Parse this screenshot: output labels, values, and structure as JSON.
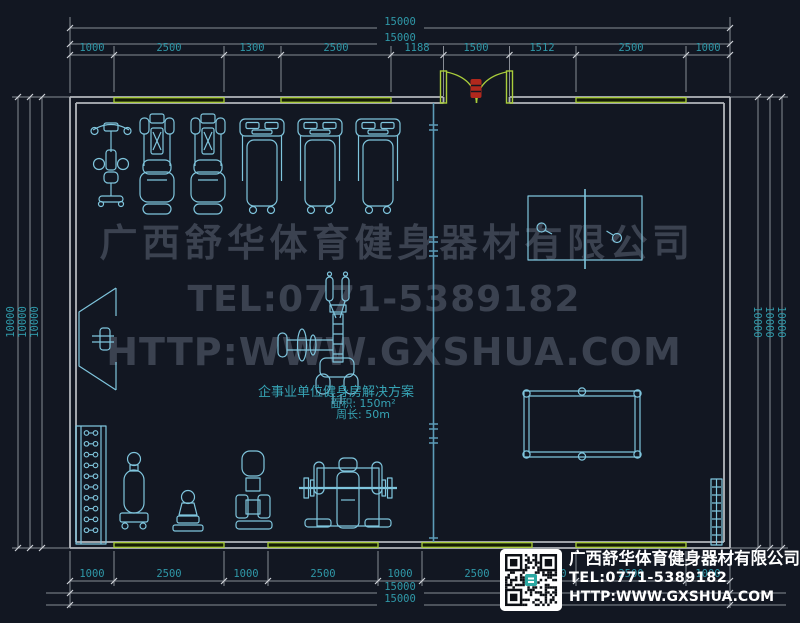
{
  "watermark": {
    "company": "广西舒华体育健身器材有限公司",
    "tel": "TEL:0771-5389182",
    "url": "HTTP:WWW.GXSHUA.COM"
  },
  "room_label": {
    "title": "企事业单位健身房解决方案",
    "area": "面积: 150m²",
    "perimeter": "周长: 50m"
  },
  "dimensions": {
    "top": {
      "total_outer": "15000",
      "total_inner": "15000",
      "segments": [
        "1000",
        "2500",
        "1300",
        "2500",
        "1188",
        "1500",
        "1512",
        "2500",
        "1000"
      ]
    },
    "bottom": {
      "segments": [
        "1000",
        "2500",
        "1000",
        "2500",
        "1000",
        "2500",
        "1000",
        "2500",
        "1000"
      ],
      "total_inner": "15000",
      "total_outer": "15000"
    },
    "left": [
      "10000",
      "10000",
      "10000"
    ],
    "right": [
      "10000",
      "10000",
      "10000"
    ]
  },
  "title_block": {
    "company": "广西舒华体育健身器材有限公司",
    "tel": "TEL:0771-5389182",
    "url": "HTTP:WWW.GXSHUA.COM"
  },
  "colors": {
    "background": "#121722",
    "wall_gray": "#b2b6bc",
    "dim_line_gray": "#878c94",
    "dim_text_teal": "#2f98a8",
    "equipment_cyan": "#7fc5dd",
    "partition_cyan": "#5c9cb8",
    "window_green": "#a9cd3b",
    "door_red": "#b0281d",
    "watermark_gray": "#3b4250",
    "title_text_white": "#ffffff"
  }
}
